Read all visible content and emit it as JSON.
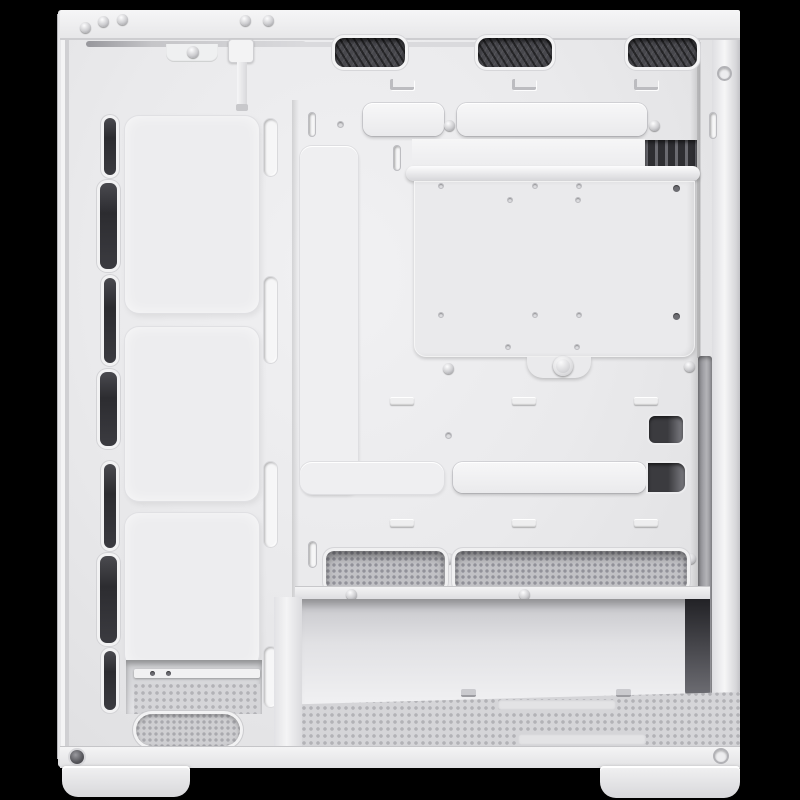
{
  "image": {
    "description": "Interior side view of a white ATX mid-tower PC case with the side panel removed, rendered on a black background",
    "background_color": "#000000"
  },
  "palette": {
    "case_white": "#ebebed",
    "highlight_white": "#f7f7f8",
    "seam_gray": "#c9c9cc",
    "opening_dark": "#303034",
    "mesh_dark": "#48484d",
    "filter_gray": "#d5d5d8"
  },
  "parts": {
    "case": {
      "label": "white PC case interior"
    },
    "top_rail": {
      "label": "top frame rail",
      "screw_count": 5
    },
    "top_vents": {
      "label": "top fan vent mesh cutouts",
      "count": 3
    },
    "front_fan_column": {
      "label": "front fan mounting column",
      "pad_count": 3,
      "intake_slot_count": 7
    },
    "cable_cutouts": {
      "label": "cable routing cutout covers",
      "count": 4
    },
    "cable_channel": {
      "label": "vertical cable channel cover"
    },
    "motherboard_plate": {
      "label": "removable motherboard tray plate",
      "thumbscrew_count": 1,
      "standoff_hole_count": 12
    },
    "rear_expansion_fins": {
      "label": "rear expansion slot covers visible through cutout"
    },
    "psu_shroud_vents": {
      "label": "PSU shroud mesh slots",
      "count": 2
    },
    "psu_bay": {
      "label": "open PSU bay"
    },
    "bottom_dust_filter": {
      "label": "perforated bottom dust filter"
    },
    "front_bottom_vent": {
      "label": "oval perforated front floor vent"
    },
    "front_panel_cable": {
      "label": "front panel cable with connector"
    },
    "feet": {
      "label": "case feet",
      "count": 2
    },
    "rear_flange": {
      "label": "rear side-panel mounting flange"
    }
  }
}
